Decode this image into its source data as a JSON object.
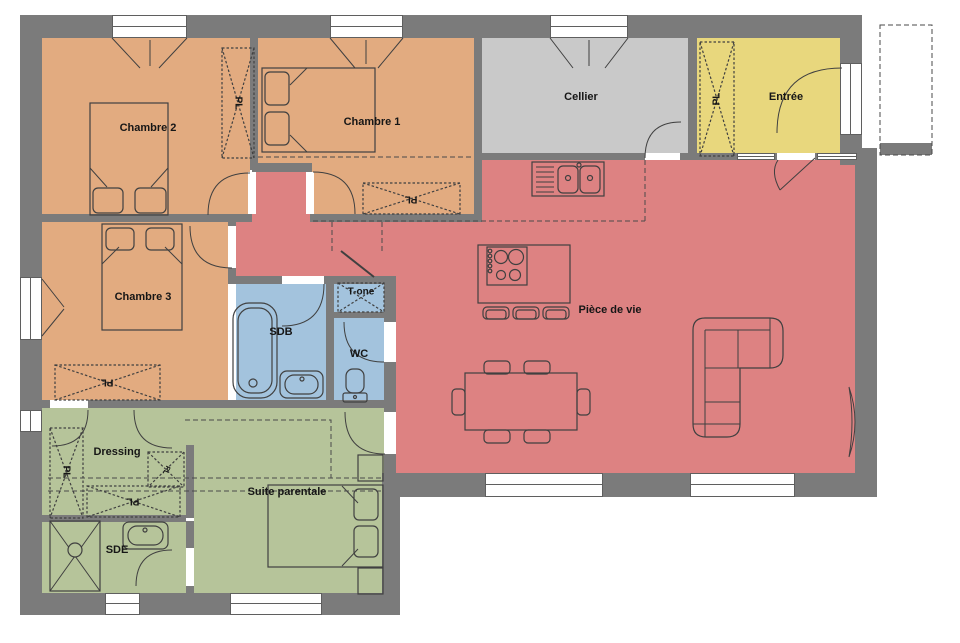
{
  "rooms": {
    "chambre2": "Chambre 2",
    "chambre1": "Chambre 1",
    "cellier": "Cellier",
    "entree": "Entrée",
    "piece_de_vie": "Pièce de vie",
    "chambre3": "Chambre 3",
    "sdb": "SDB",
    "tone": "T-one",
    "wc": "WC",
    "dressing": "Dressing",
    "suite": "Suite parentale",
    "sde": "SDE"
  },
  "labels": {
    "closet": "PL"
  },
  "colors": {
    "wall": "#7b7b7b",
    "bedroom": "#e2ab80",
    "living": "#dd8282",
    "cellier": "#c9c9c9",
    "entry": "#e8d77d",
    "bath": "#a3c3dd",
    "suite": "#b6c49a",
    "outline": "#404040"
  }
}
